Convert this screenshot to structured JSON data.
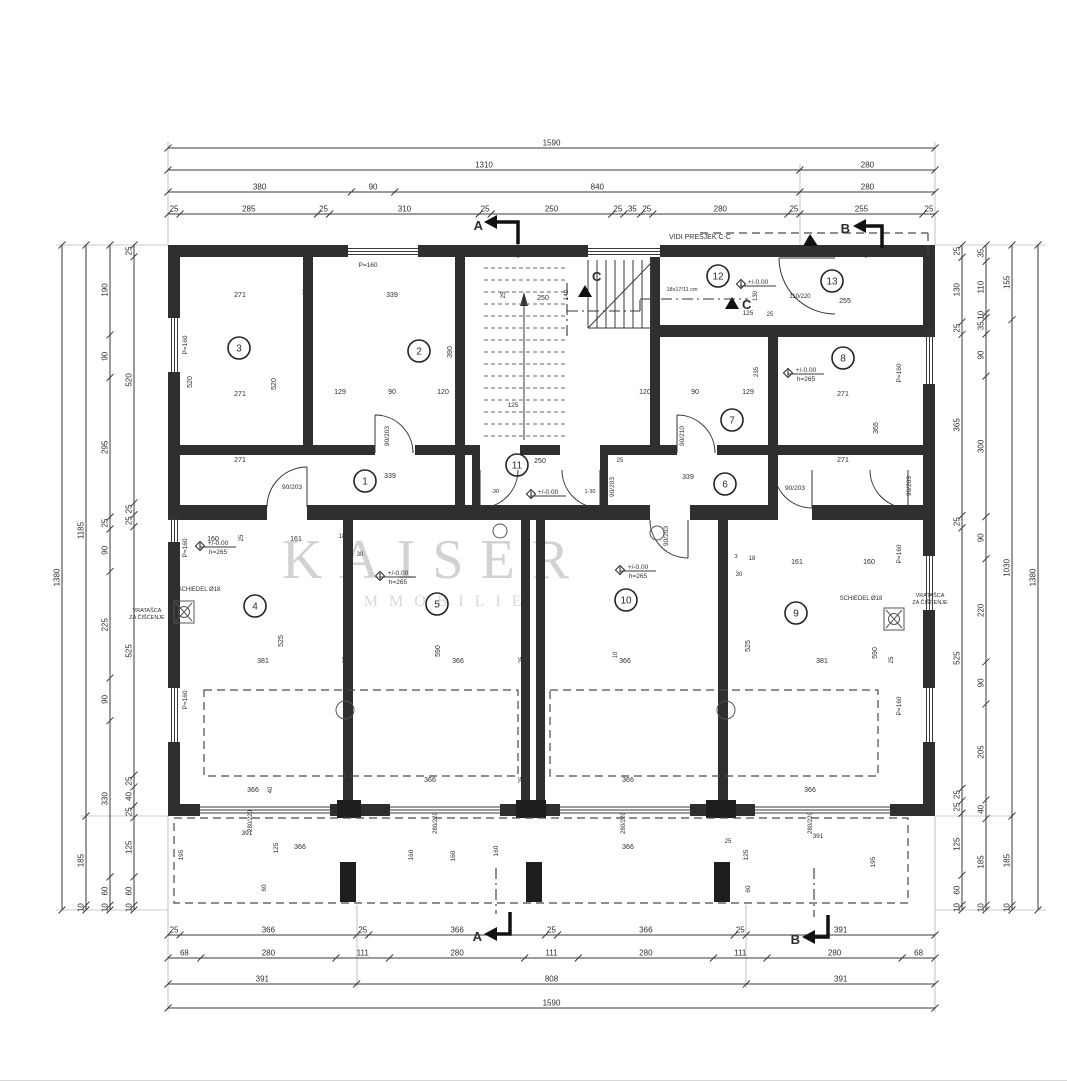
{
  "watermark": {
    "name": "KAISER",
    "sub": "IMMOBILIE"
  },
  "sections": {
    "a": "A",
    "b": "B",
    "c": "C"
  },
  "rooms": [
    "1",
    "2",
    "3",
    "4",
    "5",
    "6",
    "7",
    "8",
    "9",
    "10",
    "11",
    "12",
    "13"
  ],
  "chains": {
    "top": {
      "rows": [
        [
          "1590"
        ],
        [
          "1310",
          "280"
        ],
        [
          "380",
          "90",
          "840",
          "280"
        ],
        [
          "25",
          "285",
          "25",
          "310",
          "25",
          "250",
          "25",
          "35",
          "25",
          "280",
          "25",
          "255",
          "25"
        ]
      ]
    },
    "bottom": {
      "rows": [
        [
          "25",
          "366",
          "25",
          "366",
          "25",
          "366",
          "25",
          "391"
        ],
        [
          "68",
          "280",
          "111",
          "280",
          "111",
          "280",
          "111",
          "280",
          "68"
        ],
        [
          "391",
          "808",
          "391"
        ],
        [
          "1590"
        ]
      ]
    },
    "left": {
      "rows": [
        [
          "1380"
        ],
        [
          "1185",
          "185",
          "10"
        ],
        [
          "190",
          "90",
          "295",
          "25",
          "90",
          "225",
          "90",
          "330",
          "60",
          "10"
        ],
        [
          "25",
          "520",
          "25",
          "25",
          "525",
          "25",
          "40",
          "25",
          "125",
          "60",
          "10"
        ]
      ]
    },
    "right": {
      "rows": [
        [
          "25",
          "130",
          "25",
          "365",
          "25",
          "525",
          "25",
          "25",
          "125",
          "60",
          "10"
        ],
        [
          "35",
          "110",
          "10",
          "35",
          "90",
          "300",
          "90",
          "220",
          "90",
          "205",
          "40",
          "185",
          "10"
        ],
        [
          "155",
          "1030",
          "185",
          "10"
        ],
        [
          "1380"
        ]
      ]
    }
  },
  "v": {
    "3": "3",
    "10": "10",
    "18": "18",
    "25": "25",
    "30": "30",
    "40": "40",
    "60": "60",
    "90": "90",
    "120": "120",
    "125": "125",
    "129": "129",
    "130": "130",
    "140": "140",
    "160": "160",
    "161": "161",
    "195": "195",
    "235": "235",
    "250": "250",
    "255": "255",
    "271": "271",
    "339": "339",
    "365": "365",
    "366": "366",
    "381": "381",
    "390": "390",
    "391": "391",
    "520": "520",
    "525": "525",
    "590": "590",
    "d110220": "110/220",
    "d280220": "280/220"
  },
  "n": {
    "vidi": "VIDI PRESJEK C-C",
    "stairs": "18x17/11 cm",
    "level": "+/-0.00",
    "height": "h=265",
    "parapet": "P=160",
    "schiedel": "SCHIEDEL Ø18",
    "vratasca1": "VRATAŠCA",
    "vratasca2": "ZA ČIŠĆENJE",
    "d90203": "90/203",
    "d90210": "90/210",
    "m30": "-30",
    "m30b": "1-30"
  }
}
